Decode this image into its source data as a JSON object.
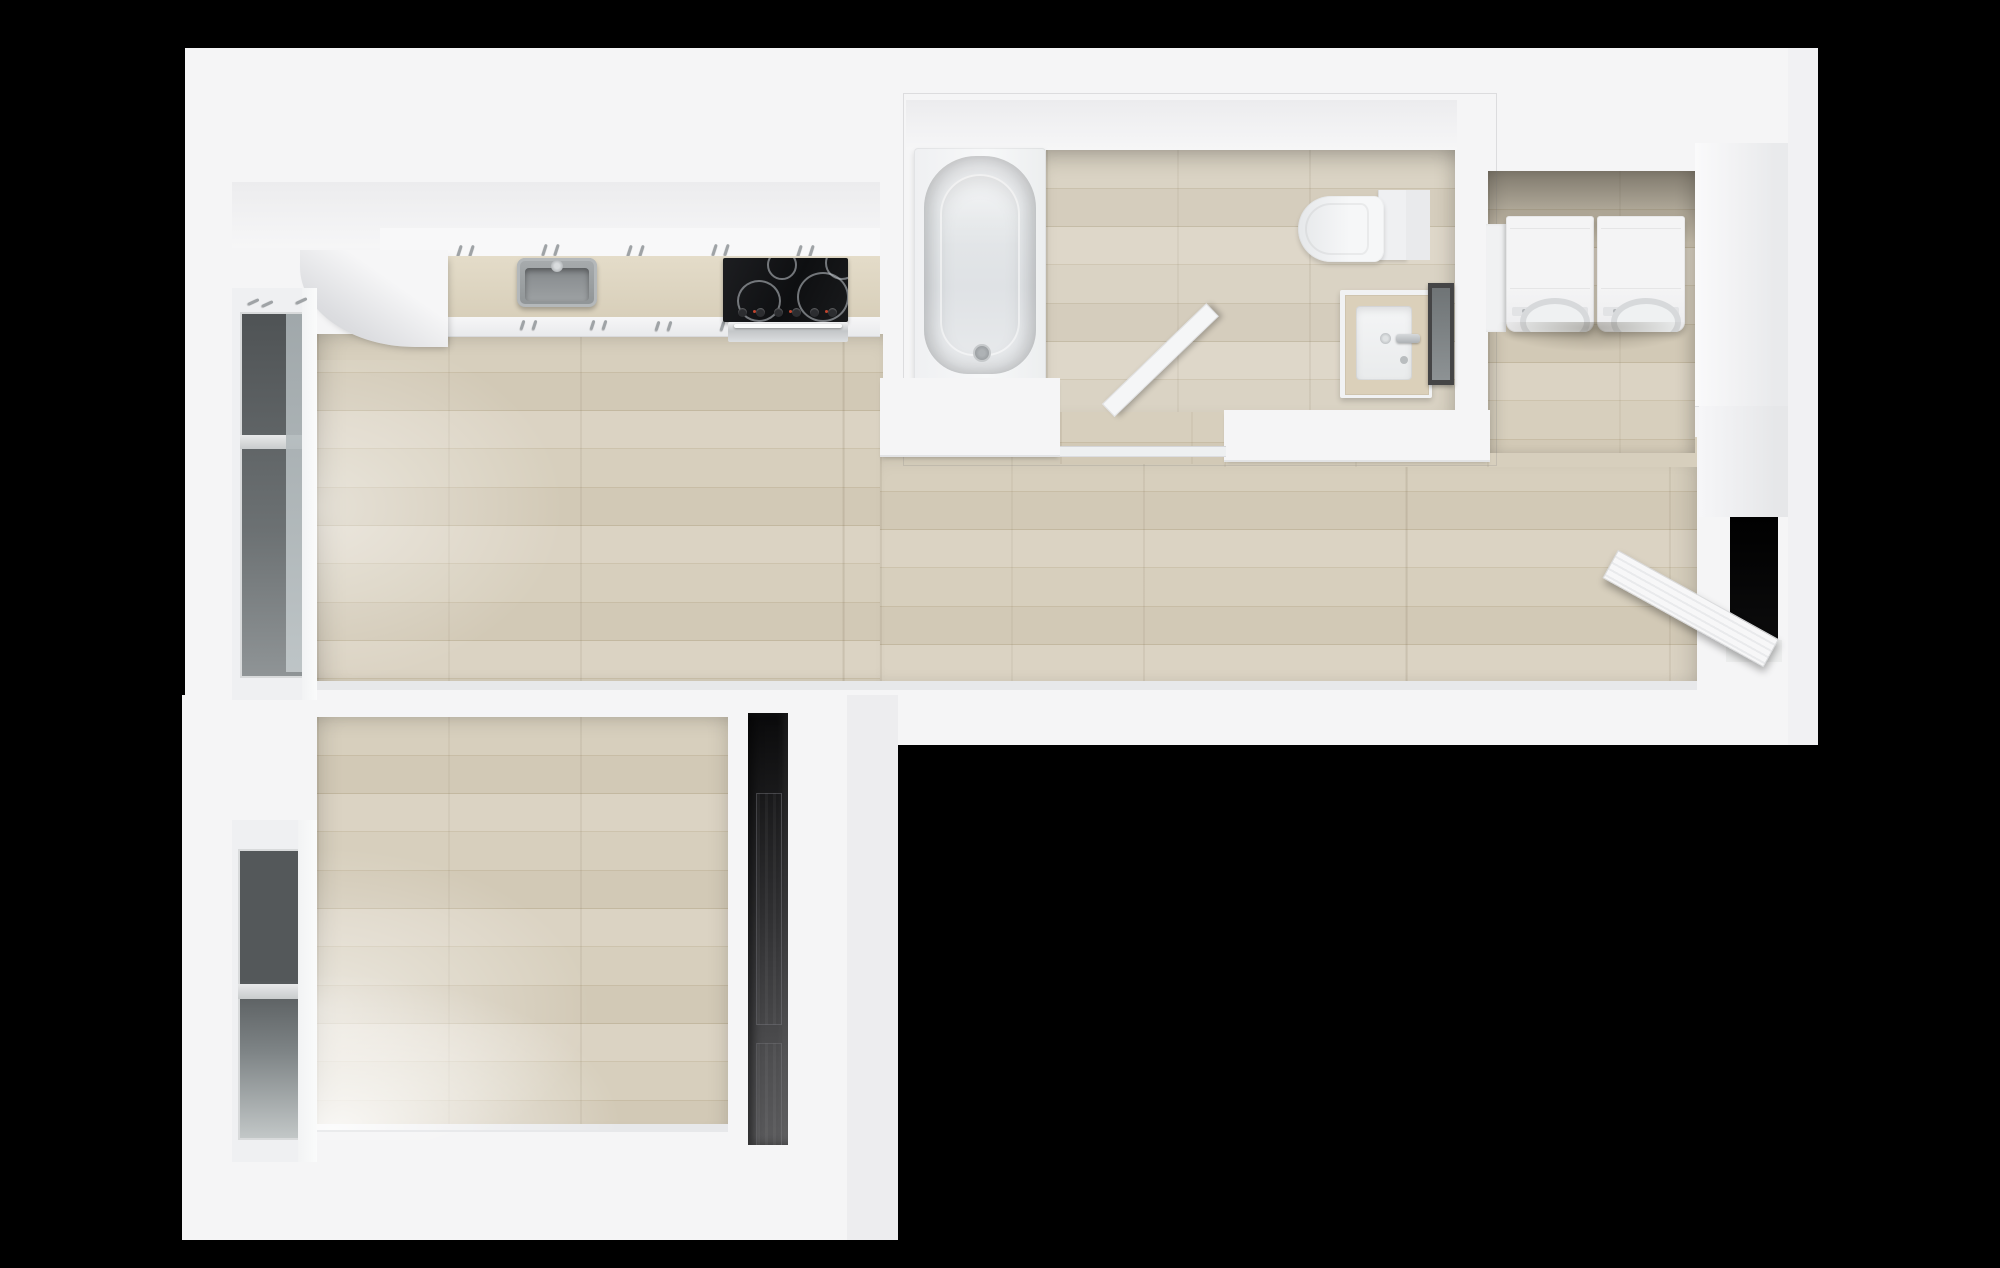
{
  "meta": {
    "title": "Top-down 3D render of a small apartment floor plan",
    "background_color": "#000000",
    "render_style": "photoreal top-down dollhouse view, no text labels"
  },
  "palette": {
    "wall_white": "#f5f5f6",
    "wall_shadow": "#ececee",
    "floor_wood_light": "#dbd3c3",
    "floor_wood_dark": "#c3b8a0",
    "counter_beige": "#ded5c1",
    "cooktop_black": "#17181a",
    "stainless": "#9aa0a2",
    "window_glass": "#54585a",
    "closet_dark": "#141415",
    "doorway_black": "#000000"
  },
  "rooms": {
    "living_kitchen": {
      "label": "Open kitchen and living area with light wood plank floor"
    },
    "bathroom": {
      "label": "Bathroom with tub, toilet and vanity"
    },
    "laundry": {
      "label": "Laundry nook with side-by-side washer and dryer"
    },
    "bedroom": {
      "label": "Bedroom with tall west window"
    },
    "closet": {
      "label": "Dark closet with paneled wardrobe doors"
    },
    "entry": {
      "label": "Entry with open door and dark doorway"
    }
  },
  "fixtures": {
    "kitchen": {
      "upper_cabinets": "white upper cabinet run with metal handles",
      "counter": "beige countertop run along north wall",
      "corner_cabinet": "white curved-front corner cabinet",
      "sink": "stainless single-basin inset sink with faucet",
      "cooktop": "black 4-burner cooktop with control knobs",
      "oven": "stainless oven front with handle bar"
    },
    "bathroom": {
      "bathtub": "white alcove bathtub with drain, west end",
      "toilet": "white toilet with tank, north-east corner",
      "vanity": "beige-top vanity with white basin and chrome faucet",
      "mirror": "dark-framed wall mirror on east wall",
      "door": "white door swung open into bathroom",
      "track": "door threshold track at south opening"
    },
    "laundry": {
      "washer": "white front-load washer",
      "dryer": "white front-load dryer",
      "pedestal": "white side cabinet"
    },
    "windows": {
      "living_window": "tall dark-glass window, living area west wall",
      "bedroom_window": "tall dark-glass window, bedroom west wall"
    },
    "entry": {
      "doorway": "dark open doorway in east wall",
      "door": "white slatted entry door swung open"
    }
  }
}
